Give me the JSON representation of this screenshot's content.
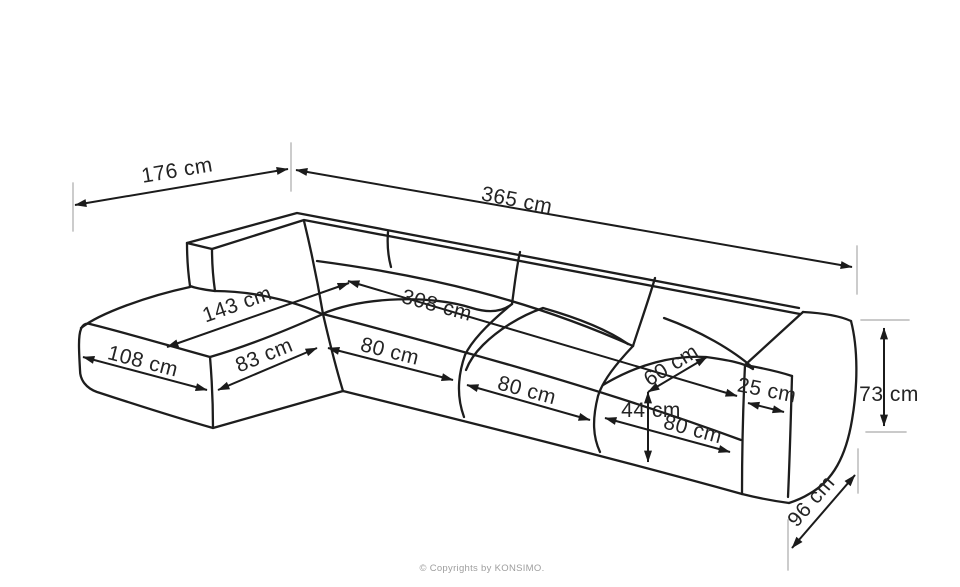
{
  "diagram": {
    "type": "sofa-dimension-diagram",
    "unit": "cm",
    "dimensions": [
      {
        "name": "chaise-overall-depth",
        "label": "176 cm",
        "value": 176
      },
      {
        "name": "overall-width",
        "label": "365 cm",
        "value": 365
      },
      {
        "name": "chaise-length",
        "label": "143 cm",
        "value": 143
      },
      {
        "name": "seat-width",
        "label": "308 cm",
        "value": 308
      },
      {
        "name": "chaise-front-width",
        "label": "108 cm",
        "value": 108
      },
      {
        "name": "chaise-side-length",
        "label": "83 cm",
        "value": 83
      },
      {
        "name": "seat-module-1-width",
        "label": "80 cm",
        "value": 80
      },
      {
        "name": "seat-module-2-width",
        "label": "80 cm",
        "value": 80
      },
      {
        "name": "seat-module-3-width",
        "label": "80 cm",
        "value": 80
      },
      {
        "name": "seat-depth",
        "label": "60 cm",
        "value": 60
      },
      {
        "name": "seat-height",
        "label": "44 cm",
        "value": 44
      },
      {
        "name": "armrest-width",
        "label": "25 cm",
        "value": 25
      },
      {
        "name": "overall-height",
        "label": "73 cm",
        "value": 73
      },
      {
        "name": "overall-depth",
        "label": "96 cm",
        "value": 96
      }
    ],
    "copyright": "© Copyrights by KONSIMO.",
    "colors": {
      "outline": "#1d1d1d",
      "dimension_line": "#1b1b1b",
      "extension_line": "#c3c3c3",
      "label_text": "#242424",
      "copyright_text": "#9e9e9e",
      "background": "#ffffff"
    }
  }
}
